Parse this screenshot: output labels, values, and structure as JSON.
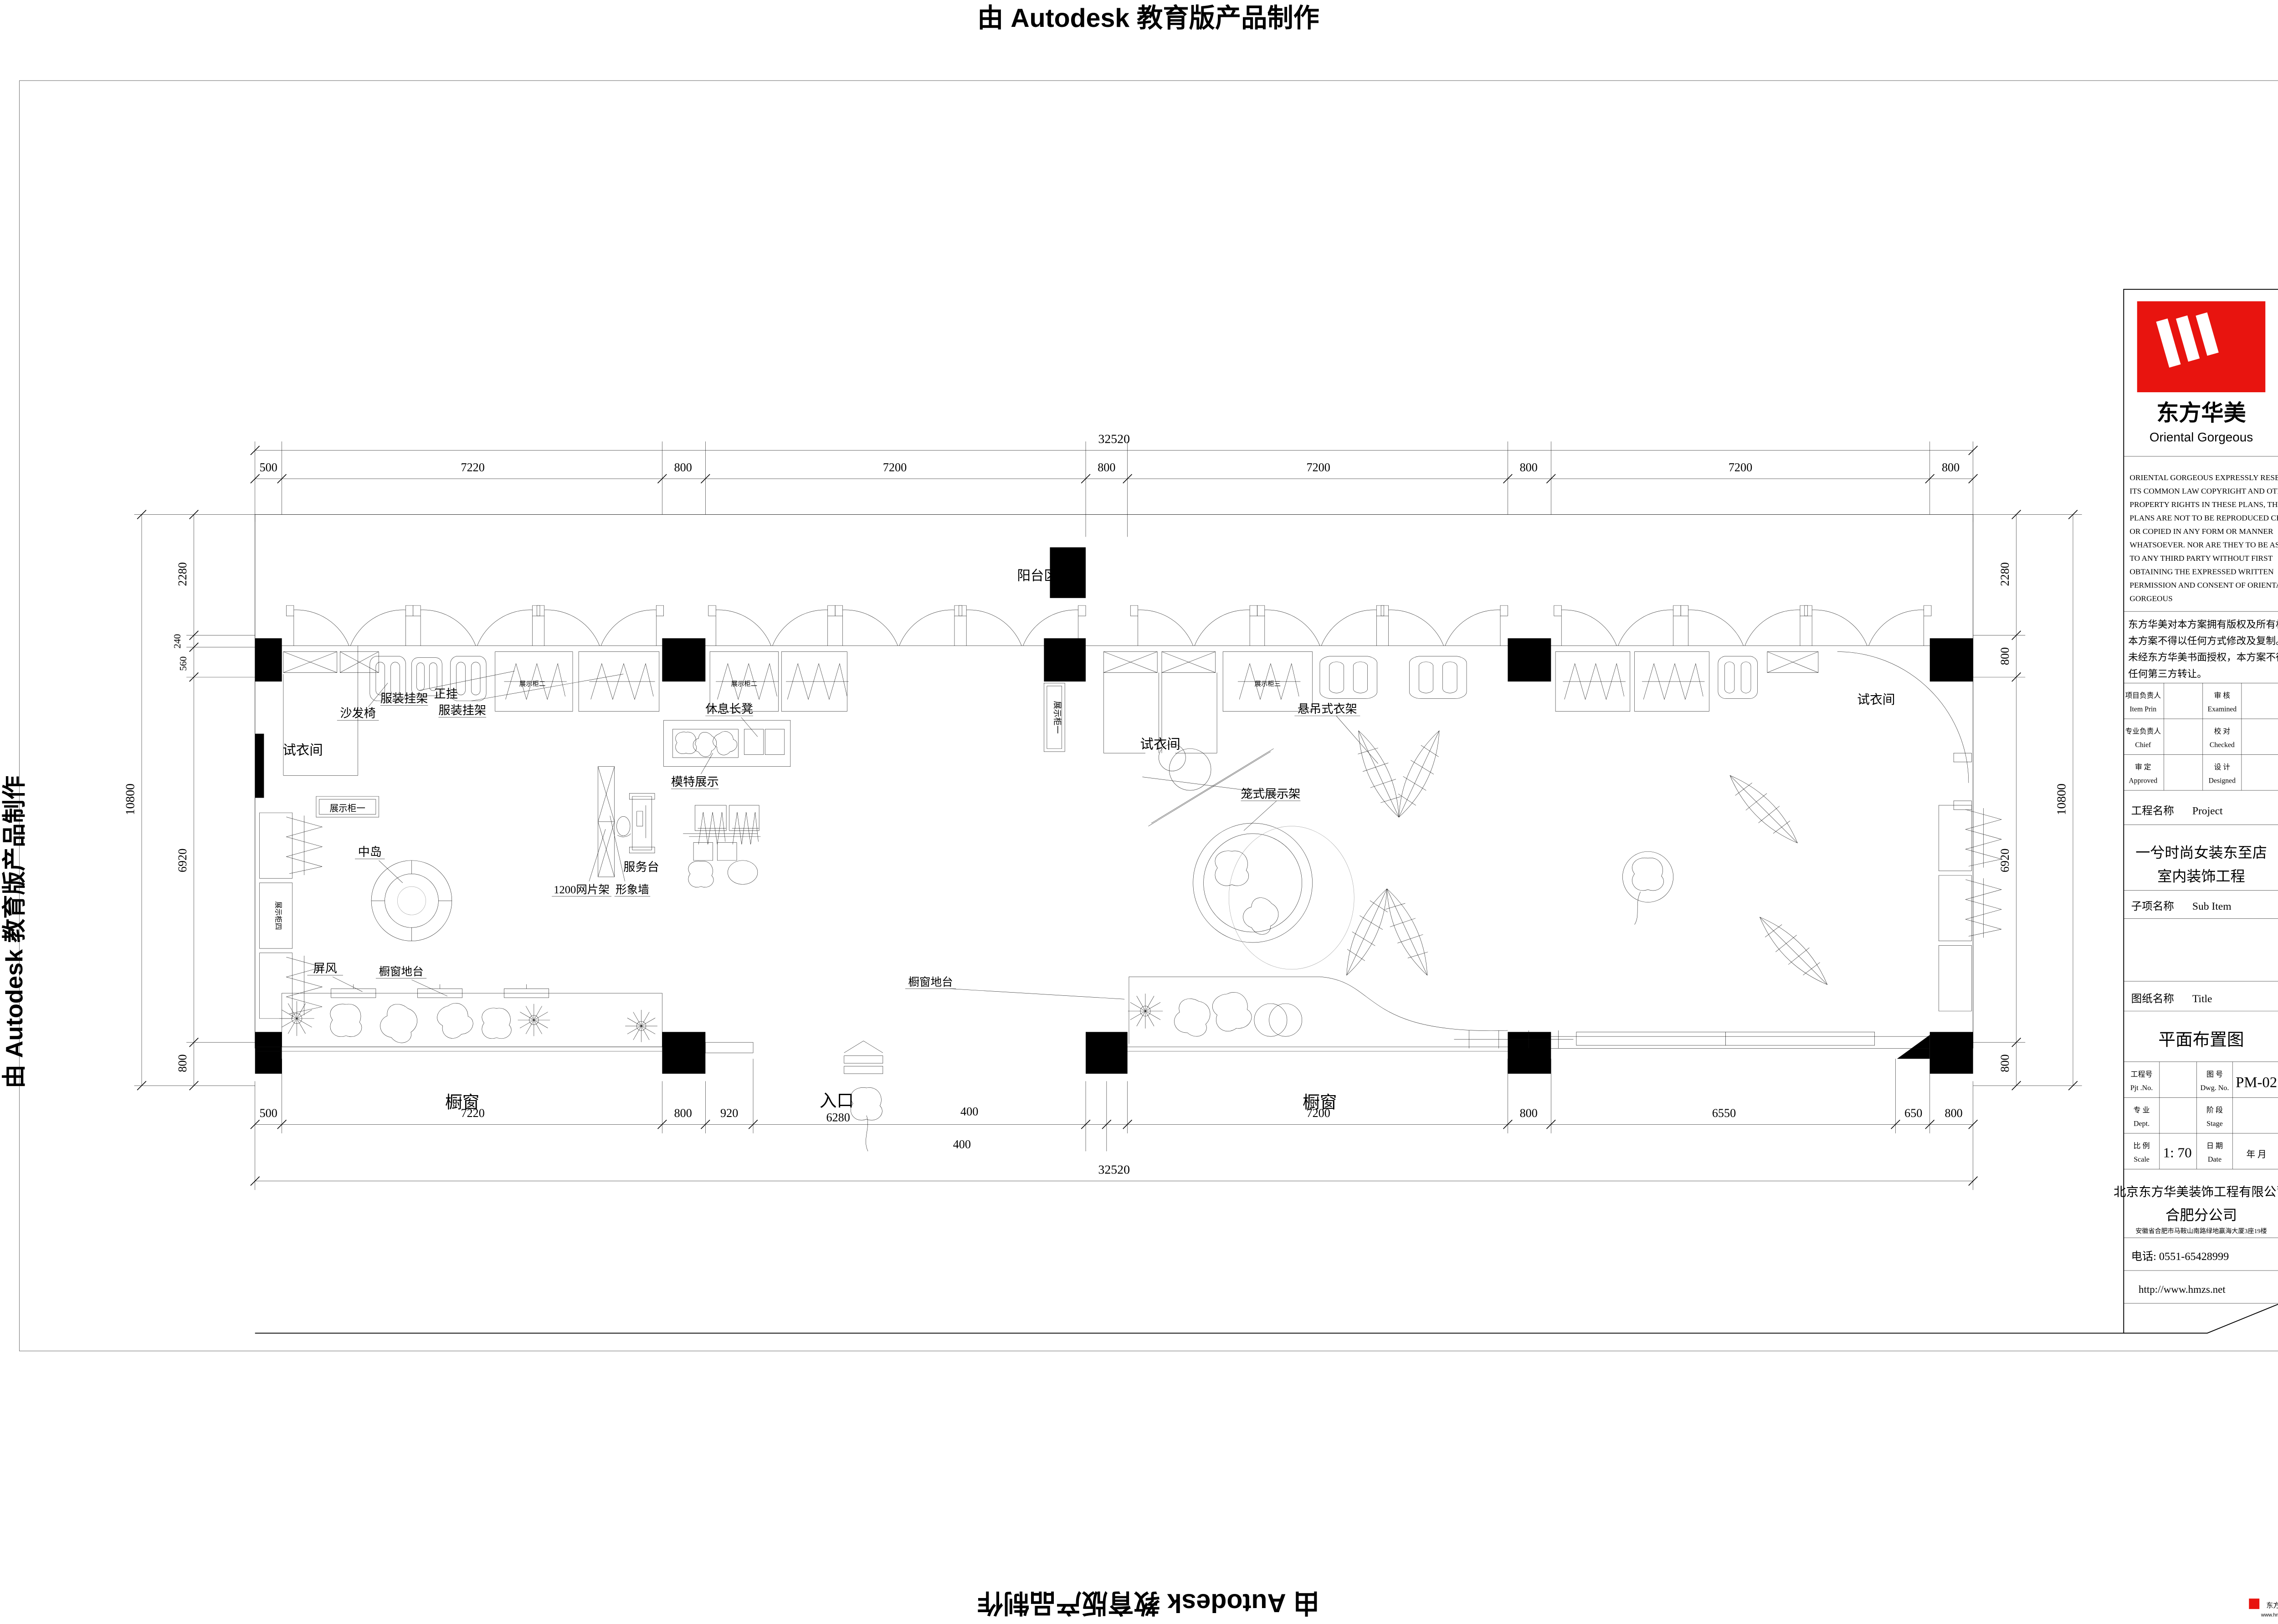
{
  "watermark": {
    "text": "由 Autodesk 教育版产品制作"
  },
  "footer_badge": {
    "brand": "东方华美",
    "site": "www.hmzs.net"
  },
  "title_block": {
    "brand_cn": "东方华美",
    "brand_en": "Oriental  Gorgeous",
    "copyright_en": [
      "ORIENTAL GORGEOUS EXPRESSLY RESERVES",
      "ITS COMMON LAW COPYRIGHT AND OTHER",
      "PROPERTY RIGHTS IN THESE PLANS, THESE",
      "PLANS ARE NOT TO BE REPRODUCED CHANGED",
      "OR COPIED IN ANY FORM OR MANNER",
      "WHATSOEVER. NOR ARE THEY TO BE ASSIGHED",
      "TO ANY THIRD PARTY WITHOUT FIRST",
      "OBTAINING THE EXPRESSED WRITTEN",
      "PERMISSION AND CONSENT OF ORIENTAL",
      "GORGEOUS"
    ],
    "copyright_cn": [
      "东方华美对本方案拥有版权及所有权。",
      "本方案不得以任何方式修改及复制。",
      "未经东方华美书面授权，本方案不得向",
      "任何第三方转让。"
    ],
    "signoff": {
      "item_prin_cn": "项目负责人",
      "item_prin_en": "Item Prin",
      "examined_cn": "审 核",
      "examined_en": "Examined",
      "chief_cn": "专业负责人",
      "chief_en": "Chief",
      "checked_cn": "校 对",
      "checked_en": "Checked",
      "approved_cn": "审 定",
      "approved_en": "Approved",
      "designed_cn": "设 计",
      "designed_en": "Designed"
    },
    "project_label_cn": "工程名称",
    "project_label_en": "Project",
    "project_name_1": "一兮时尚女装东至店",
    "project_name_2": "室内装饰工程",
    "subitem_label_cn": "子项名称",
    "subitem_label_en": "Sub Item",
    "sheet_label_cn": "图纸名称",
    "sheet_label_en": "Title",
    "sheet_name": "平面布置图",
    "fields": {
      "pjt_cn": "工程号",
      "pjt_en": "Pjt .No.",
      "dwg_cn": "图 号",
      "dwg_en": "Dwg. No.",
      "dwg_no": "PM-02",
      "dept_cn": "专 业",
      "dept_en": "Dept.",
      "stage_cn": "阶 段",
      "stage_en": "Stage",
      "scale_cn": "比 例",
      "scale_en": "Scale",
      "scale_value": "1: 70",
      "date_cn": "日 期",
      "date_en": "Date",
      "date_value": "年    月"
    },
    "company_1": "北京东方华美装饰工程有限公司",
    "company_2": "合肥分公司",
    "address": "安徽省合肥市马鞍山南路绿地赢海大厦3座19楼",
    "phone": "电话: 0551-65428999",
    "website": "http://www.hmzs.net"
  },
  "plan": {
    "labels": {
      "balcony": "阳台区域",
      "fitting_left": "试衣间",
      "fitting_center": "试衣间",
      "fitting_right": "试衣间",
      "sofa_chair": "沙发椅",
      "rack1": "服装挂架",
      "front_hang": "正挂",
      "rack2": "服装挂架",
      "bench": "休息长凳",
      "mannequin_display": "模特展示",
      "island": "中岛",
      "mesh_rack": "1200网片架",
      "image_wall": "形象墙",
      "service_desk": "服务台",
      "screen": "屏风",
      "window_platform_left": "橱窗地台",
      "window_platform_right": "橱窗地台",
      "window_left": "橱窗",
      "window_right": "橱窗",
      "entrance": "入口",
      "cage_rack": "笼式展示架",
      "hanging_rack": "悬吊式衣架",
      "cabinet1_h": "展示柜一",
      "cabinet1_v": "展示柜一",
      "cabinet2a": "展示柜二",
      "cabinet2b": "展示柜二",
      "cabinet3": "展示柜三",
      "cabinet4": "展示柜四"
    },
    "dims": {
      "total": "32520",
      "side_total": "10800",
      "top": [
        "500",
        "7220",
        "800",
        "7200",
        "800",
        "7200",
        "800",
        "7200",
        "800"
      ],
      "bottom": [
        "500",
        "7220",
        "800",
        "920",
        "6280",
        "400",
        "400",
        "7200",
        "800",
        "6550",
        "650",
        "800"
      ],
      "left": [
        "2280",
        "240",
        "560",
        "6920",
        "800"
      ],
      "right": [
        "2280",
        "800",
        "6920",
        "800"
      ]
    }
  }
}
